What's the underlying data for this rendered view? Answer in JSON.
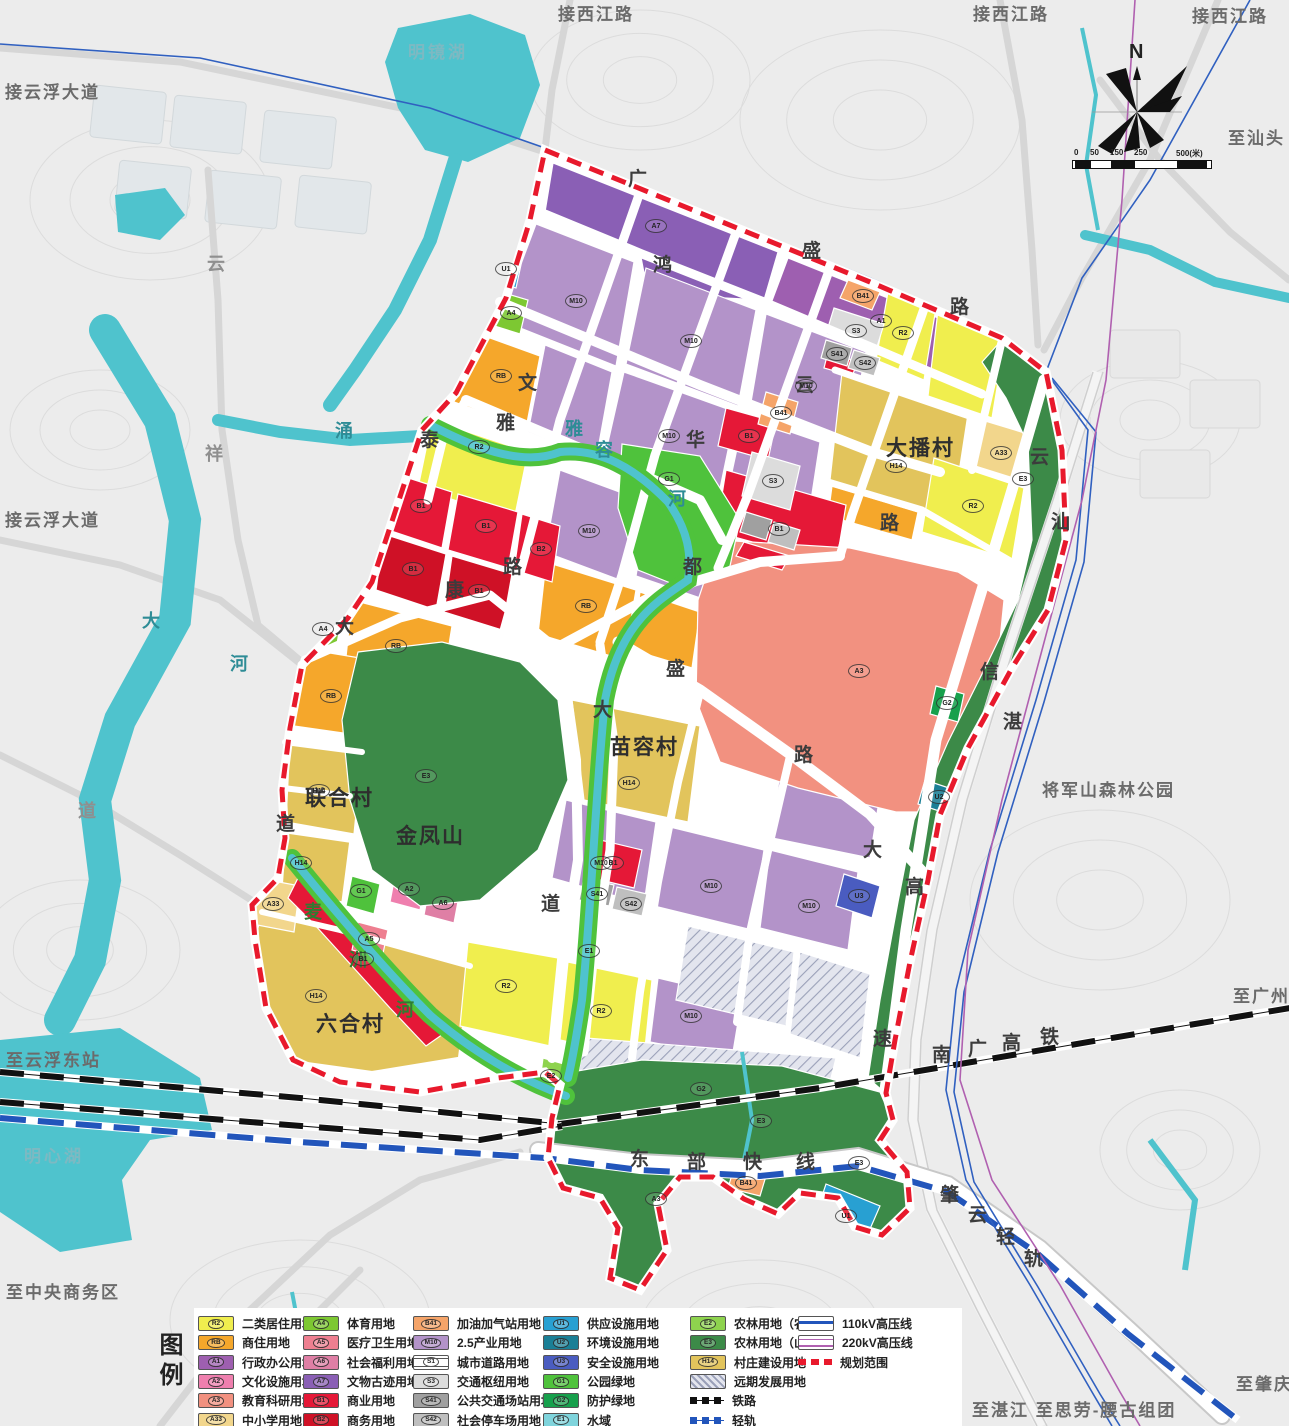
{
  "map": {
    "colors": {
      "water": "#4fc3cd",
      "terrain": "#ececec",
      "road_outside": "#d6d6d6",
      "boundary": "#e8192c",
      "rail": "#111111",
      "lightrail": "#2255bb",
      "power110": "#3060c0",
      "power220": "#b060b0"
    },
    "compass": {
      "north_label": "N"
    },
    "scale": {
      "ticks": [
        "0",
        "50",
        "150",
        "250",
        "500(米)"
      ],
      "tick_x": [
        2,
        18,
        38,
        62,
        104
      ]
    },
    "labels": [
      {
        "t": "接西江路",
        "x": 558,
        "y": 6,
        "c": "ext"
      },
      {
        "t": "接西江路",
        "x": 973,
        "y": 6,
        "c": "ext"
      },
      {
        "t": "接西江路",
        "x": 1192,
        "y": 8,
        "c": "ext"
      },
      {
        "t": "接云浮大道",
        "x": 5,
        "y": 84,
        "c": "ext"
      },
      {
        "t": "接云浮大道",
        "x": 5,
        "y": 512,
        "c": "ext"
      },
      {
        "t": "至汕头",
        "x": 1228,
        "y": 130,
        "c": "ext"
      },
      {
        "t": "至广州",
        "x": 1233,
        "y": 988,
        "c": "ext"
      },
      {
        "t": "至肇庆",
        "x": 1236,
        "y": 1376,
        "c": "ext"
      },
      {
        "t": "至湛江  至思劳-腰古组团",
        "x": 972,
        "y": 1402,
        "c": "ext"
      },
      {
        "t": "至云浮东站",
        "x": 6,
        "y": 1052,
        "c": "ext"
      },
      {
        "t": "至中央商务区",
        "x": 6,
        "y": 1284,
        "c": "ext"
      },
      {
        "t": "将军山森林公园",
        "x": 1042,
        "y": 782,
        "c": "ext"
      },
      {
        "t": "明镜湖",
        "x": 408,
        "y": 44,
        "c": "waterlb"
      },
      {
        "t": "明心湖",
        "x": 24,
        "y": 1148,
        "c": "waterlb"
      },
      {
        "t": "大播村",
        "x": 886,
        "y": 438,
        "c": "village"
      },
      {
        "t": "苗容村",
        "x": 610,
        "y": 737,
        "c": "village"
      },
      {
        "t": "联合村",
        "x": 305,
        "y": 788,
        "c": "village"
      },
      {
        "t": "金凤山",
        "x": 396,
        "y": 826,
        "c": "village"
      },
      {
        "t": "六合村",
        "x": 316,
        "y": 1014,
        "c": "village"
      },
      {
        "t": "广",
        "x": 628,
        "y": 170,
        "c": "roadchar"
      },
      {
        "t": "鸿",
        "x": 653,
        "y": 256,
        "c": "roadchar"
      },
      {
        "t": "盛",
        "x": 802,
        "y": 242,
        "c": "roadchar"
      },
      {
        "t": "路",
        "x": 950,
        "y": 298,
        "c": "roadchar"
      },
      {
        "t": "云",
        "x": 795,
        "y": 376,
        "c": "roadchar"
      },
      {
        "t": "文",
        "x": 518,
        "y": 374,
        "c": "roadchar"
      },
      {
        "t": "雅",
        "x": 496,
        "y": 414,
        "c": "roadchar"
      },
      {
        "t": "泰",
        "x": 420,
        "y": 431,
        "c": "roadchar"
      },
      {
        "t": "康",
        "x": 445,
        "y": 581,
        "c": "roadchar"
      },
      {
        "t": "路",
        "x": 503,
        "y": 558,
        "c": "roadchar"
      },
      {
        "t": "华",
        "x": 686,
        "y": 431,
        "c": "roadchar"
      },
      {
        "t": "都",
        "x": 683,
        "y": 558,
        "c": "roadchar"
      },
      {
        "t": "盛",
        "x": 666,
        "y": 660,
        "c": "roadchar"
      },
      {
        "t": "大",
        "x": 593,
        "y": 701,
        "c": "roadchar"
      },
      {
        "t": "路",
        "x": 794,
        "y": 746,
        "c": "roadchar"
      },
      {
        "t": "道",
        "x": 541,
        "y": 895,
        "c": "roadchar"
      },
      {
        "t": "大",
        "x": 335,
        "y": 618,
        "c": "roadchar"
      },
      {
        "t": "道",
        "x": 276,
        "y": 815,
        "c": "roadchar"
      },
      {
        "t": "云",
        "x": 1030,
        "y": 448,
        "c": "roadchar"
      },
      {
        "t": "汕",
        "x": 1051,
        "y": 513,
        "c": "roadchar"
      },
      {
        "t": "信",
        "x": 980,
        "y": 663,
        "c": "roadchar"
      },
      {
        "t": "湛",
        "x": 1003,
        "y": 713,
        "c": "roadchar"
      },
      {
        "t": "大",
        "x": 863,
        "y": 841,
        "c": "roadchar"
      },
      {
        "t": "高",
        "x": 905,
        "y": 878,
        "c": "roadchar"
      },
      {
        "t": "速",
        "x": 873,
        "y": 1030,
        "c": "roadchar"
      },
      {
        "t": "路",
        "x": 880,
        "y": 514,
        "c": "roadchar"
      },
      {
        "t": "东",
        "x": 630,
        "y": 1150,
        "c": "roadchar"
      },
      {
        "t": "部",
        "x": 687,
        "y": 1153,
        "c": "roadchar"
      },
      {
        "t": "快",
        "x": 743,
        "y": 1153,
        "c": "roadchar"
      },
      {
        "t": "线",
        "x": 796,
        "y": 1153,
        "c": "roadchar"
      },
      {
        "t": "南",
        "x": 932,
        "y": 1046,
        "c": "roadchar"
      },
      {
        "t": "广",
        "x": 968,
        "y": 1040,
        "c": "roadchar"
      },
      {
        "t": "高",
        "x": 1002,
        "y": 1034,
        "c": "roadchar"
      },
      {
        "t": "铁",
        "x": 1040,
        "y": 1028,
        "c": "roadchar"
      },
      {
        "t": "肇",
        "x": 940,
        "y": 1186,
        "c": "roadchar"
      },
      {
        "t": "云",
        "x": 968,
        "y": 1206,
        "c": "roadchar"
      },
      {
        "t": "轻",
        "x": 996,
        "y": 1228,
        "c": "roadchar"
      },
      {
        "t": "轨",
        "x": 1024,
        "y": 1250,
        "c": "roadchar"
      },
      {
        "t": "雅",
        "x": 565,
        "y": 420,
        "c": "rivchar"
      },
      {
        "t": "容",
        "x": 595,
        "y": 441,
        "c": "rivchar"
      },
      {
        "t": "河",
        "x": 668,
        "y": 490,
        "c": "rivchar"
      },
      {
        "t": "大",
        "x": 142,
        "y": 612,
        "c": "rivchar"
      },
      {
        "t": "河",
        "x": 230,
        "y": 655,
        "c": "rivchar"
      },
      {
        "t": "涌",
        "x": 335,
        "y": 422,
        "c": "rivchar"
      },
      {
        "t": "云",
        "x": 207,
        "y": 255,
        "c": "graychar"
      },
      {
        "t": "祥",
        "x": 205,
        "y": 445,
        "c": "graychar"
      },
      {
        "t": "道",
        "x": 78,
        "y": 802,
        "c": "graychar"
      },
      {
        "t": "麦",
        "x": 304,
        "y": 903,
        "c": "greenchar"
      },
      {
        "t": "洲",
        "x": 349,
        "y": 951,
        "c": "greenchar"
      },
      {
        "t": "河",
        "x": 396,
        "y": 1001,
        "c": "greenchar"
      },
      {
        "t": "图例",
        "x": 156,
        "y": 1332,
        "c": "legendtitle vert"
      }
    ],
    "parcel_codes": [
      {
        "k": "A7",
        "x": 655,
        "y": 225
      },
      {
        "k": "A1",
        "x": 880,
        "y": 320
      },
      {
        "k": "M10",
        "x": 575,
        "y": 300
      },
      {
        "k": "M10",
        "x": 690,
        "y": 340
      },
      {
        "k": "M10",
        "x": 805,
        "y": 385
      },
      {
        "k": "M10",
        "x": 668,
        "y": 435
      },
      {
        "k": "M10",
        "x": 588,
        "y": 530
      },
      {
        "k": "M10",
        "x": 600,
        "y": 862
      },
      {
        "k": "M10",
        "x": 710,
        "y": 885
      },
      {
        "k": "M10",
        "x": 808,
        "y": 905
      },
      {
        "k": "M10",
        "x": 690,
        "y": 1015
      },
      {
        "k": "R2",
        "x": 478,
        "y": 446
      },
      {
        "k": "R2",
        "x": 902,
        "y": 332
      },
      {
        "k": "R2",
        "x": 972,
        "y": 505
      },
      {
        "k": "R2",
        "x": 505,
        "y": 985
      },
      {
        "k": "R2",
        "x": 600,
        "y": 1010
      },
      {
        "k": "RB",
        "x": 500,
        "y": 375
      },
      {
        "k": "RB",
        "x": 395,
        "y": 645
      },
      {
        "k": "RB",
        "x": 330,
        "y": 695
      },
      {
        "k": "RB",
        "x": 585,
        "y": 605
      },
      {
        "k": "B1",
        "x": 420,
        "y": 505
      },
      {
        "k": "B1",
        "x": 485,
        "y": 525
      },
      {
        "k": "B1",
        "x": 412,
        "y": 568
      },
      {
        "k": "B1",
        "x": 478,
        "y": 590
      },
      {
        "k": "B1",
        "x": 612,
        "y": 862
      },
      {
        "k": "B1",
        "x": 748,
        "y": 435
      },
      {
        "k": "B1",
        "x": 778,
        "y": 528
      },
      {
        "k": "B1",
        "x": 362,
        "y": 958
      },
      {
        "k": "B2",
        "x": 540,
        "y": 548
      },
      {
        "k": "A3",
        "x": 858,
        "y": 670
      },
      {
        "k": "A3",
        "x": 655,
        "y": 1198
      },
      {
        "k": "A33",
        "x": 1000,
        "y": 452
      },
      {
        "k": "A33",
        "x": 272,
        "y": 903
      },
      {
        "k": "A4",
        "x": 510,
        "y": 312
      },
      {
        "k": "A4",
        "x": 322,
        "y": 628
      },
      {
        "k": "A5",
        "x": 368,
        "y": 938
      },
      {
        "k": "A6",
        "x": 442,
        "y": 902
      },
      {
        "k": "A2",
        "x": 408,
        "y": 888
      },
      {
        "k": "H14",
        "x": 895,
        "y": 465
      },
      {
        "k": "H14",
        "x": 628,
        "y": 782
      },
      {
        "k": "H14",
        "x": 318,
        "y": 790
      },
      {
        "k": "H14",
        "x": 315,
        "y": 995
      },
      {
        "k": "H14",
        "x": 300,
        "y": 862
      },
      {
        "k": "S3",
        "x": 855,
        "y": 330
      },
      {
        "k": "S3",
        "x": 772,
        "y": 480
      },
      {
        "k": "S41",
        "x": 836,
        "y": 353
      },
      {
        "k": "S41",
        "x": 596,
        "y": 893
      },
      {
        "k": "S42",
        "x": 864,
        "y": 362
      },
      {
        "k": "S42",
        "x": 630,
        "y": 903
      },
      {
        "k": "B41",
        "x": 862,
        "y": 295
      },
      {
        "k": "B41",
        "x": 780,
        "y": 412
      },
      {
        "k": "B41",
        "x": 745,
        "y": 1182
      },
      {
        "k": "U1",
        "x": 505,
        "y": 268
      },
      {
        "k": "U1",
        "x": 845,
        "y": 1215
      },
      {
        "k": "U2",
        "x": 938,
        "y": 796
      },
      {
        "k": "U3",
        "x": 858,
        "y": 895
      },
      {
        "k": "G1",
        "x": 668,
        "y": 478
      },
      {
        "k": "G1",
        "x": 360,
        "y": 890
      },
      {
        "k": "G2",
        "x": 946,
        "y": 702
      },
      {
        "k": "G2",
        "x": 700,
        "y": 1088
      },
      {
        "k": "E1",
        "x": 588,
        "y": 950
      },
      {
        "k": "E2",
        "x": 550,
        "y": 1075
      },
      {
        "k": "E3",
        "x": 425,
        "y": 775
      },
      {
        "k": "E3",
        "x": 760,
        "y": 1120
      },
      {
        "k": "E3",
        "x": 1022,
        "y": 478
      },
      {
        "k": "E3",
        "x": 858,
        "y": 1162
      }
    ]
  },
  "legend": {
    "title": "图例",
    "columns": [
      [
        {
          "code": "R2",
          "label": "二类居住用地",
          "type": "fill",
          "color": "#f0ee4e"
        },
        {
          "code": "RB",
          "label": "商住用地",
          "type": "fill",
          "color": "#f5a72b"
        },
        {
          "code": "A1",
          "label": "行政办公用地",
          "type": "fill",
          "color": "#9e5fb0"
        },
        {
          "code": "A2",
          "label": "文化设施用地",
          "type": "fill",
          "color": "#ef7fae"
        },
        {
          "code": "A3",
          "label": "教育科研用地",
          "type": "fill",
          "color": "#f29180"
        },
        {
          "code": "A33",
          "label": "中小学用地",
          "type": "fill",
          "color": "#f2d68c"
        }
      ],
      [
        {
          "code": "A4",
          "label": "体育用地",
          "type": "fill",
          "color": "#7dc832"
        },
        {
          "code": "A5",
          "label": "医疗卫生用地",
          "type": "fill",
          "color": "#ee7f90"
        },
        {
          "code": "A6",
          "label": "社会福利用地",
          "type": "fill",
          "color": "#df7fa5"
        },
        {
          "code": "A7",
          "label": "文物古迹用地",
          "type": "fill",
          "color": "#8a5fb5"
        },
        {
          "code": "B1",
          "label": "商业用地",
          "type": "fill",
          "color": "#e51837"
        },
        {
          "code": "B2",
          "label": "商务用地",
          "type": "fill",
          "color": "#cf1126"
        }
      ],
      [
        {
          "code": "B41",
          "label": "加油加气站用地",
          "type": "fill",
          "color": "#f5a469"
        },
        {
          "code": "M10",
          "label": "2.5产业用地",
          "type": "fill",
          "color": "#b393c9"
        },
        {
          "code": "S1",
          "label": "城市道路用地",
          "type": "road"
        },
        {
          "code": "S3",
          "label": "交通枢纽用地",
          "type": "fill",
          "color": "#dcdcdc"
        },
        {
          "code": "S41",
          "label": "公共交通场站用地",
          "type": "fill",
          "color": "#a0a0a0"
        },
        {
          "code": "S42",
          "label": "社会停车场用地",
          "type": "fill",
          "color": "#bfbfbf"
        }
      ],
      [
        {
          "code": "U1",
          "label": "供应设施用地",
          "type": "fill",
          "color": "#28a0d2"
        },
        {
          "code": "U2",
          "label": "环境设施用地",
          "type": "fill",
          "color": "#1a7f96"
        },
        {
          "code": "U3",
          "label": "安全设施用地",
          "type": "fill",
          "color": "#4a5cc0"
        },
        {
          "code": "G1",
          "label": "公园绿地",
          "type": "fill",
          "color": "#4fc23c"
        },
        {
          "code": "G2",
          "label": "防护绿地",
          "type": "fill",
          "color": "#17a04c"
        },
        {
          "code": "E1",
          "label": "水域",
          "type": "fill",
          "color": "#7fd4dc"
        }
      ],
      [
        {
          "code": "E2",
          "label": "农林用地（农田）",
          "type": "fill",
          "color": "#8ed34e"
        },
        {
          "code": "E3",
          "label": "农林用地（山体）",
          "type": "fill",
          "color": "#3c8a48"
        },
        {
          "code": "H14",
          "label": "村庄建设用地",
          "type": "fill",
          "color": "#e2c45c"
        },
        {
          "code": "",
          "label": "远期发展用地",
          "type": "hatch"
        },
        {
          "code": "",
          "label": "铁路",
          "type": "rail"
        },
        {
          "code": "",
          "label": "轻轨",
          "type": "lightrail"
        }
      ],
      [
        {
          "code": "",
          "label": "110kV高压线",
          "type": "line110"
        },
        {
          "code": "",
          "label": "220kV高压线",
          "type": "line220"
        },
        {
          "code": "",
          "label": "规划范围",
          "type": "reddash"
        }
      ]
    ]
  }
}
